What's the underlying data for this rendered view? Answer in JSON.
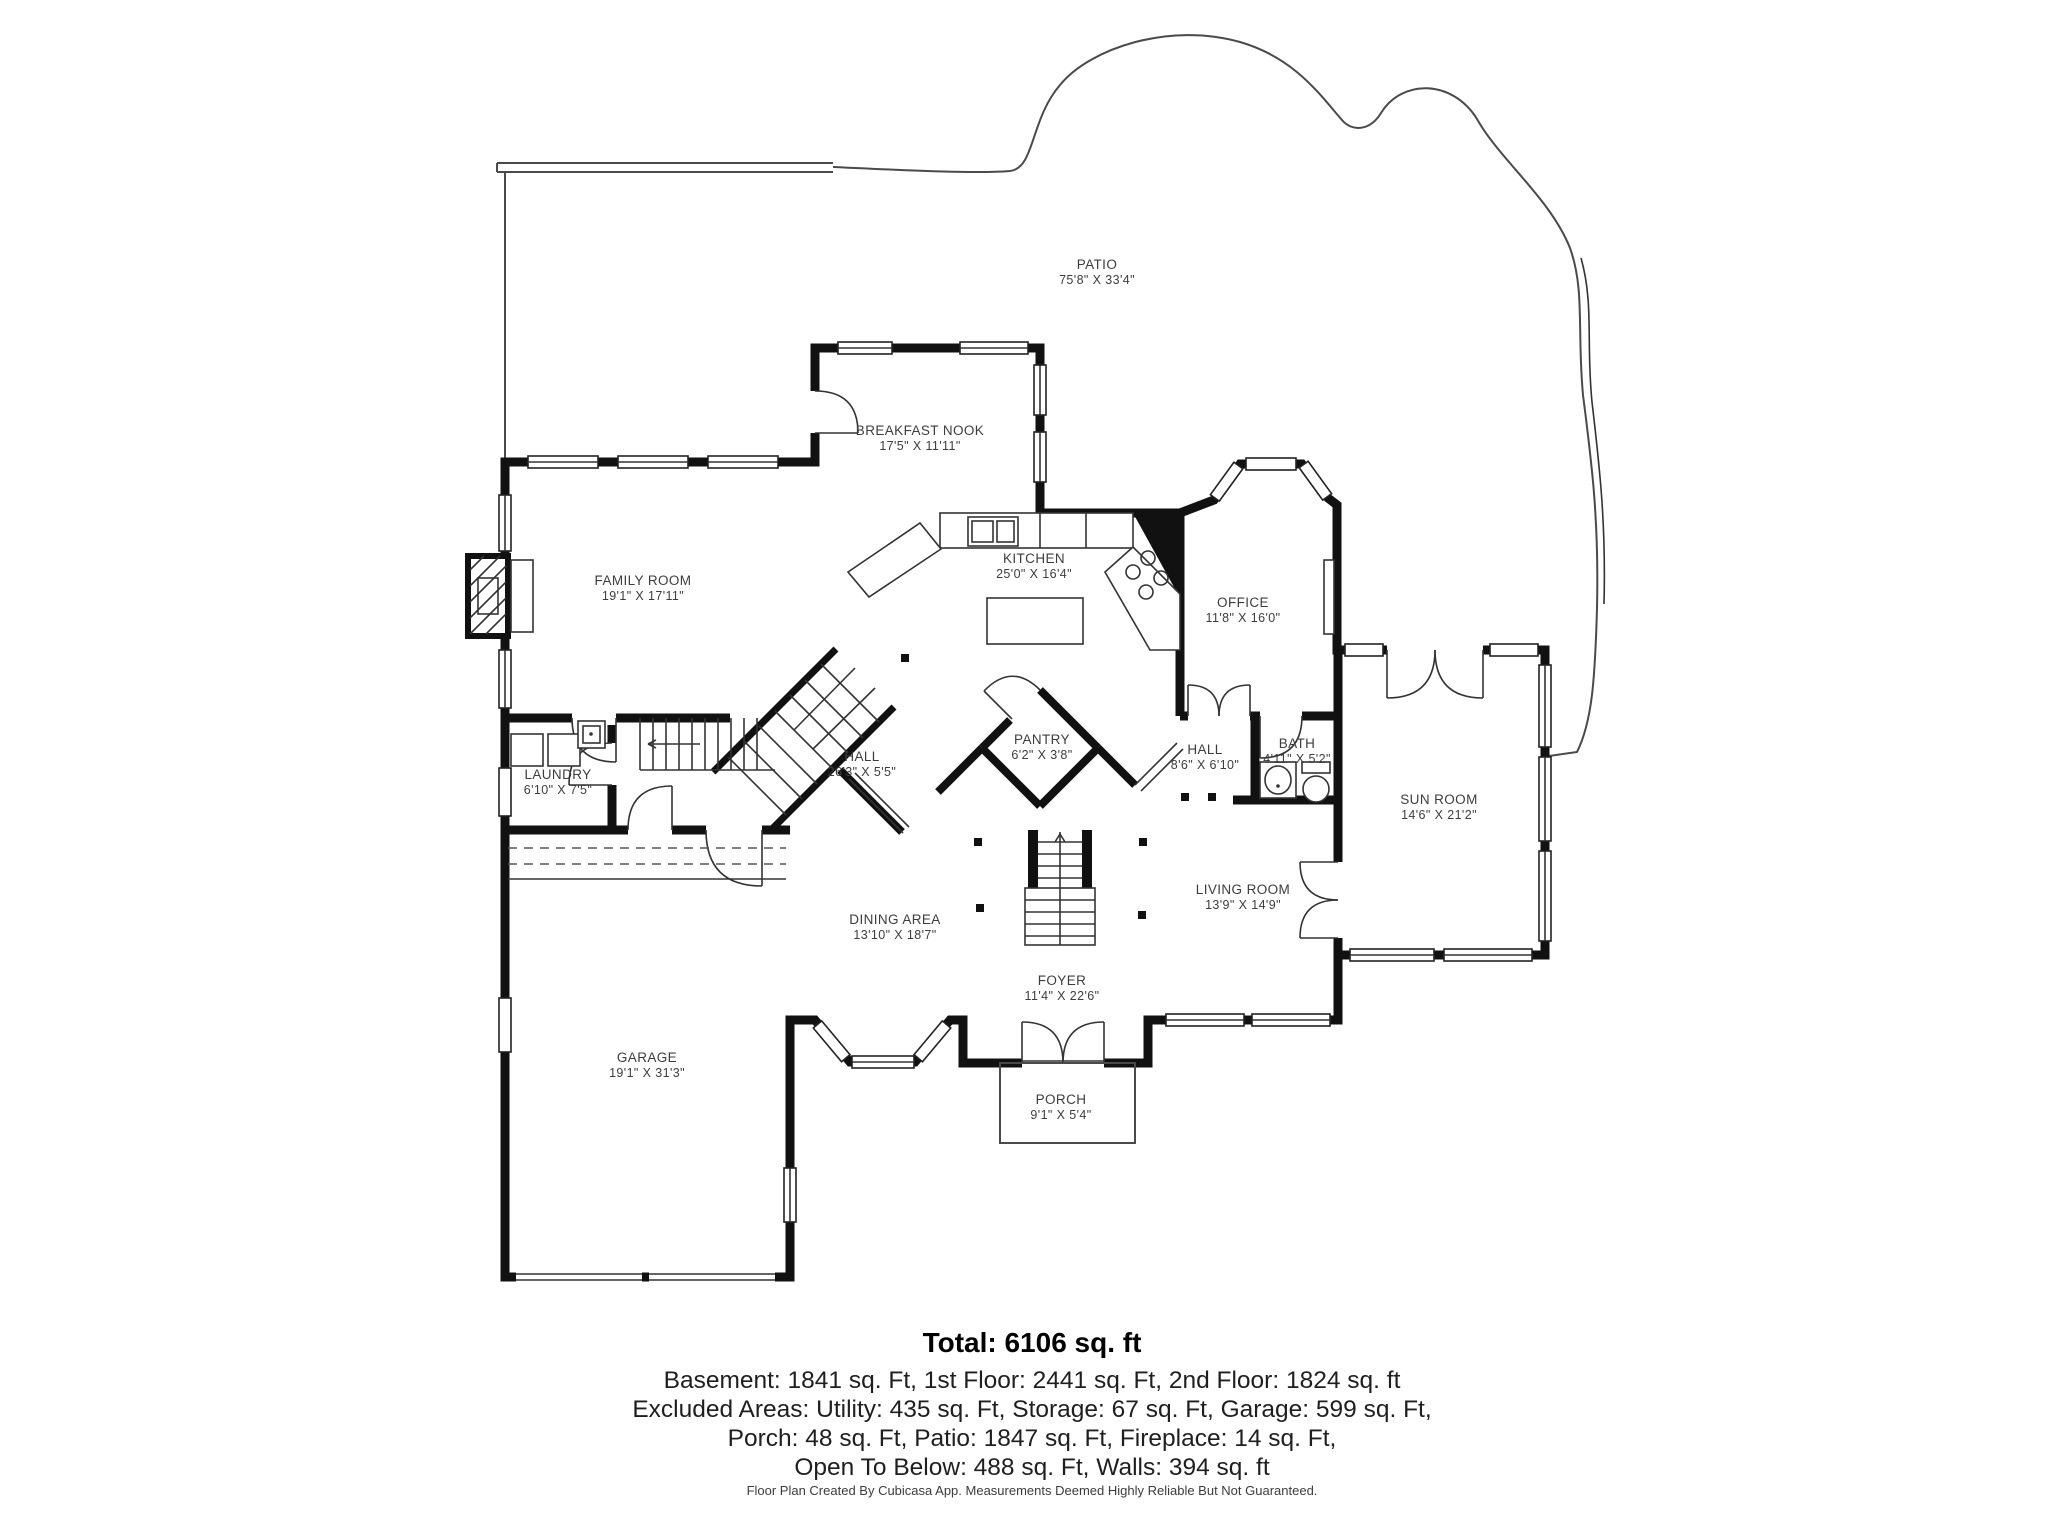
{
  "rooms": [
    {
      "name": "PATIO",
      "dims": "75'8\" X 33'4\""
    },
    {
      "name": "BREAKFAST NOOK",
      "dims": "17'5\" X 11'11\""
    },
    {
      "name": "KITCHEN",
      "dims": "25'0\" X 16'4\""
    },
    {
      "name": "FAMILY ROOM",
      "dims": "19'1\" X 17'11\""
    },
    {
      "name": "OFFICE",
      "dims": "11'8\" X 16'0\""
    },
    {
      "name": "LAUNDRY",
      "dims": "6'10\" X 7'5\""
    },
    {
      "name": "HALL",
      "dims": "26'3\" X 5'5\""
    },
    {
      "name": "PANTRY",
      "dims": "6'2\" X 3'8\""
    },
    {
      "name": "HALL",
      "dims": "8'6\" X 6'10\""
    },
    {
      "name": "BATH",
      "dims": "4'11\" X 5'2\""
    },
    {
      "name": "SUN ROOM",
      "dims": "14'6\" X 21'2\""
    },
    {
      "name": "DINING AREA",
      "dims": "13'10\" X 18'7\""
    },
    {
      "name": "LIVING ROOM",
      "dims": "13'9\" X 14'9\""
    },
    {
      "name": "FOYER",
      "dims": "11'4\" X 22'6\""
    },
    {
      "name": "GARAGE",
      "dims": "19'1\" X 31'3\""
    },
    {
      "name": "PORCH",
      "dims": "9'1\" X 5'4\""
    }
  ],
  "summary": {
    "total": "Total: 6106 sq. ft",
    "line1": "Basement: 1841 sq. Ft, 1st Floor: 2441 sq. Ft, 2nd Floor: 1824 sq. ft",
    "line2": "Excluded Areas: Utility: 435 sq. Ft, Storage: 67 sq. Ft, Garage: 599 sq. Ft,",
    "line3": "Porch: 48 sq. Ft, Patio: 1847 sq. Ft, Fireplace: 14 sq. Ft,",
    "line4": "Open To Below: 488 sq. Ft, Walls: 394 sq. ft"
  },
  "footer": "Floor Plan Created By Cubicasa App. Measurements Deemed Highly Reliable But Not Guaranteed.",
  "colors": {
    "wall": "#111111",
    "thin_line": "#4a4a4a",
    "label_text": "#3d3d3d"
  }
}
